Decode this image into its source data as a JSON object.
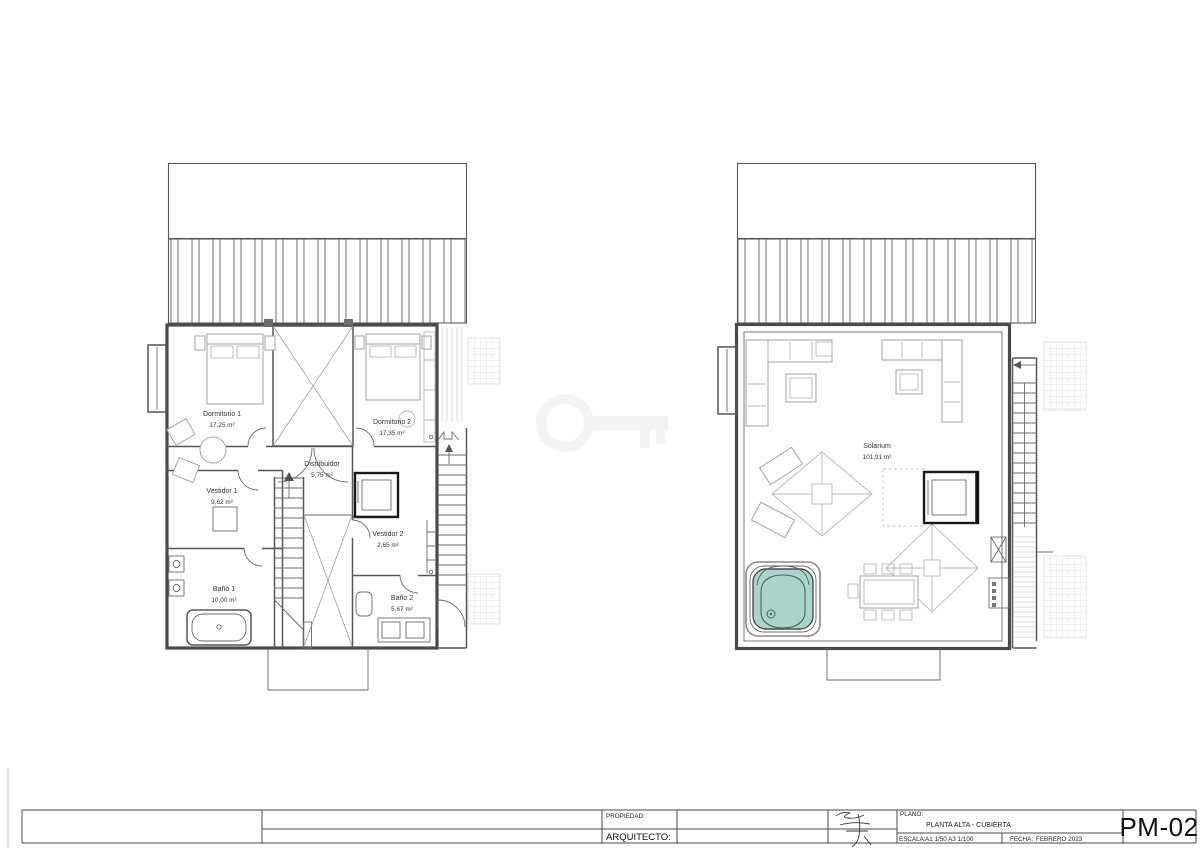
{
  "sheet_code": "PM-02",
  "title_block": {
    "propiedad_label": "PROPIEDAD:",
    "arquitecto_label": "ARQUITECTO:",
    "plano_label": "PLANO:",
    "plano_value": "PLANTA ALTA - CUBIERTA",
    "escala_label": "ESCALA:",
    "escala_value": "A1 1/50  A3 1/100",
    "fecha_label": "FECHA:",
    "fecha_value": "FEBRERO 2023"
  },
  "plans": {
    "left": {
      "name": "planta-alta",
      "rooms": [
        {
          "name": "Dormitorio 1",
          "area": "17,25 m²"
        },
        {
          "name": "Dormitorio 2",
          "area": "17,35 m²"
        },
        {
          "name": "Distribuidor",
          "area": "5,75 m²"
        },
        {
          "name": "Vestidor 1",
          "area": "9,62 m²"
        },
        {
          "name": "Vestidor 2",
          "area": "2,65 m²"
        },
        {
          "name": "Baño 1",
          "area": "10,00 m²"
        },
        {
          "name": "Baño 2",
          "area": "5,67 m²"
        }
      ]
    },
    "right": {
      "name": "cubierta",
      "rooms": [
        {
          "name": "Solarium",
          "area": "101,91 m²"
        }
      ]
    }
  },
  "icons": {
    "watermark": "key-icon",
    "stair_direction": "arrow-icon"
  },
  "colors": {
    "hot_tub_fill": "#a9d4cb",
    "ink": "#4a4a4a",
    "furniture": "#a3a3a3",
    "faint": "#dadada",
    "watermark": "#ececec"
  }
}
